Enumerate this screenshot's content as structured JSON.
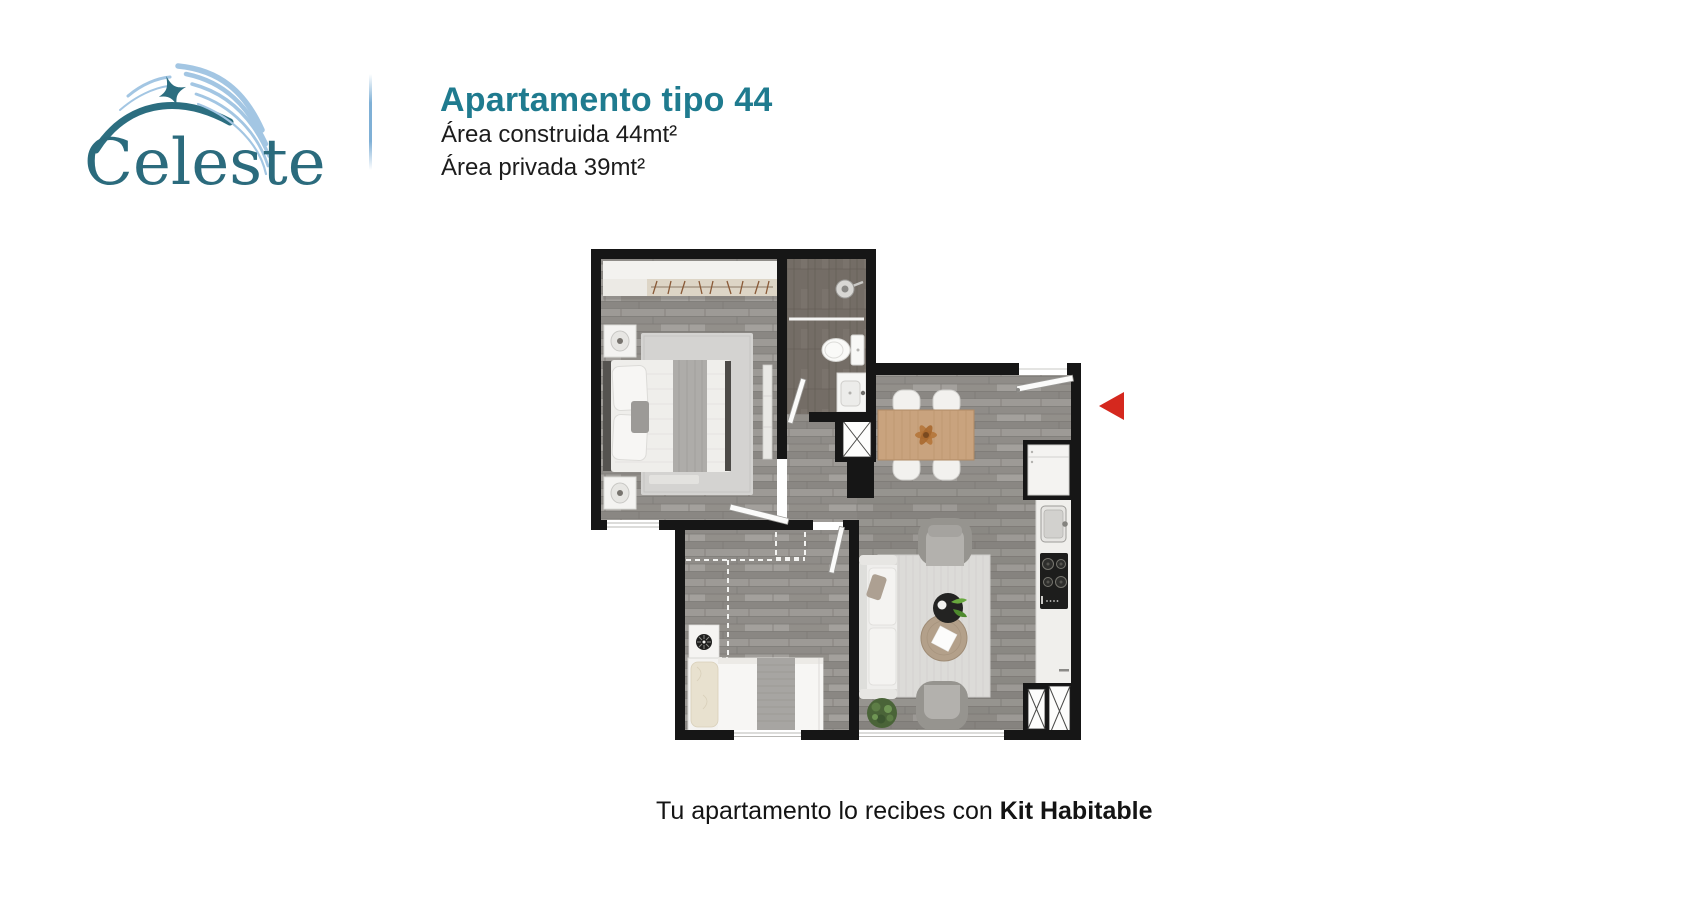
{
  "brand": {
    "logo_text": "Celeste",
    "logo_teal": "#2c6e80",
    "logo_light_blue": "#a3c6e3"
  },
  "header": {
    "title": "Apartamento tipo 44",
    "area_built": "Área construida 44mt²",
    "area_private": "Área privada 39mt²",
    "accent_color": "#1f7b8f"
  },
  "floor_plan": {
    "marker_color": "#d5281e",
    "rooms": [
      "master-bedroom",
      "bathroom",
      "hall",
      "dining-area",
      "kitchen",
      "living-area",
      "second-bedroom"
    ]
  },
  "footer": {
    "prefix": "Tu apartamento lo recibes con ",
    "highlight": "Kit Habitable"
  }
}
